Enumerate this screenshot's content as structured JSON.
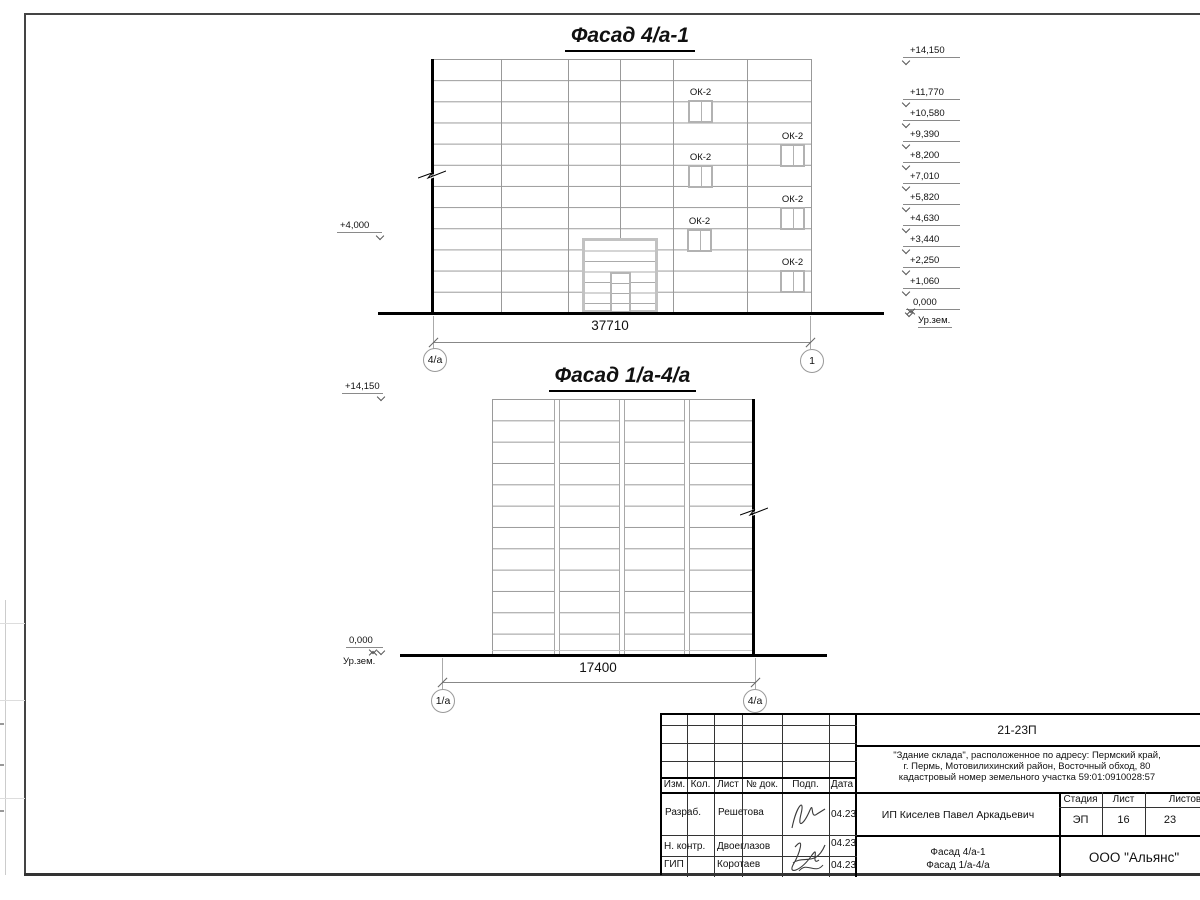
{
  "facade1": {
    "title": "Фасад 4/а-1",
    "dimension": "37710",
    "axis_left": "4/а",
    "axis_right": "1",
    "left_mark": "+4,000",
    "ground_label": "Ур.зем.",
    "windows": [
      {
        "label": "ОК-2"
      },
      {
        "label": "ОК-2"
      },
      {
        "label": "ОК-2"
      },
      {
        "label": "ОК-2"
      },
      {
        "label": "ОК-2"
      },
      {
        "label": "ОК-2"
      }
    ],
    "elevations": [
      {
        "label": "+14,150"
      },
      {
        "label": "+11,770"
      },
      {
        "label": "+10,580"
      },
      {
        "label": "+9,390"
      },
      {
        "label": "+8,200"
      },
      {
        "label": "+7,010"
      },
      {
        "label": "+5,820"
      },
      {
        "label": "+4,630"
      },
      {
        "label": "+3,440"
      },
      {
        "label": "+2,250"
      },
      {
        "label": "+1,060"
      },
      {
        "label": "0,000"
      }
    ]
  },
  "facade2": {
    "title": "Фасад 1/а-4/а",
    "dimension": "17400",
    "axis_left": "1/а",
    "axis_right": "4/а",
    "top_mark": "+14,150",
    "zero_mark": "0,000",
    "ground_label": "Ур.зем."
  },
  "title_block": {
    "code": "21-23П",
    "description_lines": [
      "\"Здание склада\", расположенное по адресу: Пермский край,",
      "г. Пермь, Мотовилихинский район, Восточный обход, 80",
      "кадастровый номер земельного участка 59:01:0910028:57"
    ],
    "header_cells": [
      "Изм.",
      "Кол.",
      "Лист",
      "№ док.",
      "Подп.",
      "Дата"
    ],
    "rows": [
      {
        "role": "Разраб.",
        "name": "Решетова",
        "date": "04.23"
      },
      {
        "role": "Н. контр.",
        "name": "Двоеглазов",
        "date": "04.23"
      },
      {
        "role": "ГИП",
        "name": "Коротаев",
        "date": "04.23"
      }
    ],
    "client": "ИП Киселев Павел Аркадьевич",
    "stage_label": "Стадия",
    "sheet_label": "Лист",
    "sheets_label": "Листов",
    "stage": "ЭП",
    "sheet": "16",
    "sheets": "23",
    "sheet_title_lines": [
      "Фасад 4/а-1",
      "Фасад 1/а-4/а"
    ],
    "company": "ООО \"Альянс\""
  }
}
